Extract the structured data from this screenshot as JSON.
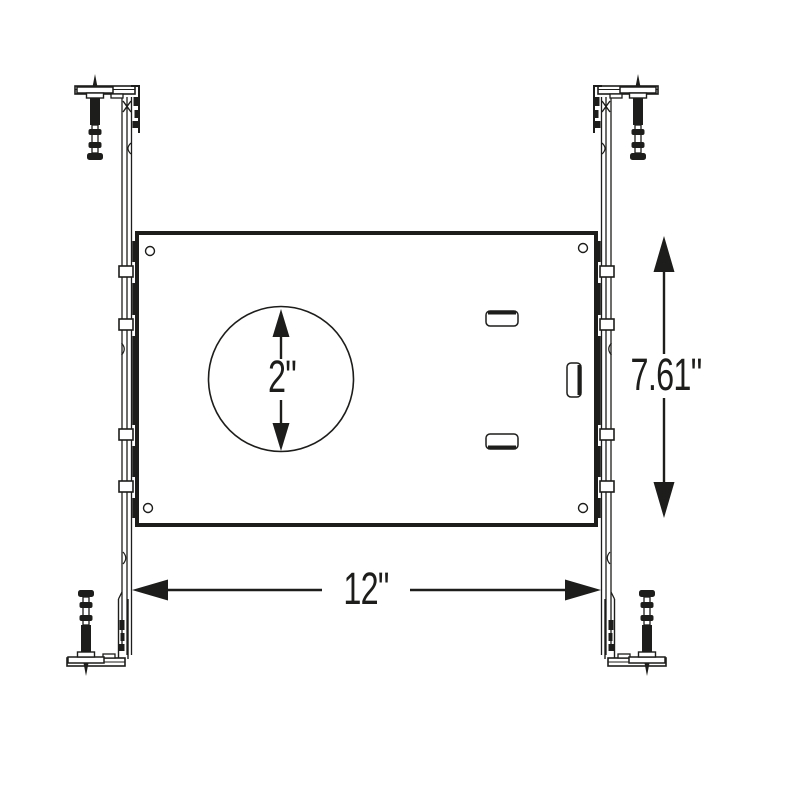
{
  "colors": {
    "ink": "#1d1d1b",
    "paper": "#ffffff"
  },
  "drawing": {
    "kind": "recessed-light-mounting-frame-dimension-drawing",
    "dimensions": {
      "cutout_diameter": {
        "label": "2\""
      },
      "plate_height": {
        "label": "7.61\""
      },
      "mounting_width": {
        "label": "12\""
      }
    }
  }
}
